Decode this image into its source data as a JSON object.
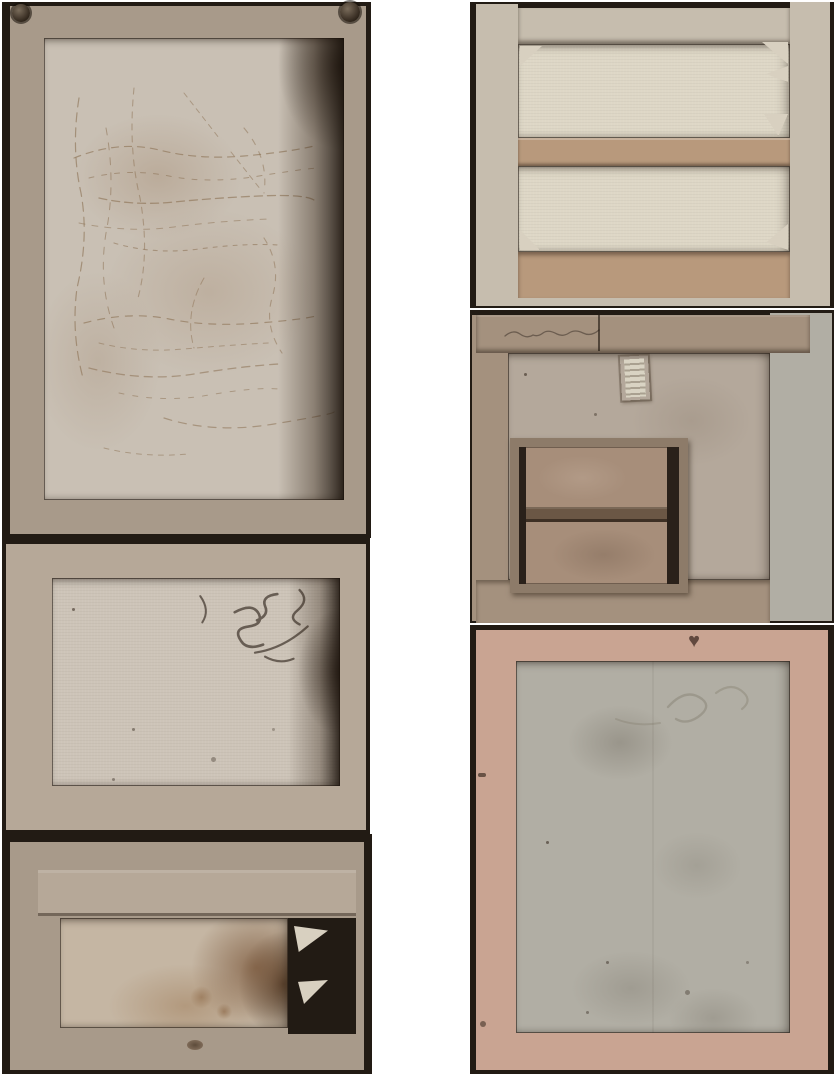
{
  "scene": {
    "type": "photograph-composite",
    "description": "Backs (versos) of six old paintings - canvases on wooden stretcher frames - photographed and arranged as two vertical columns on a white background",
    "background": "#ffffff"
  },
  "colors": {
    "edge-dark": "#221b14",
    "wood-light": "#b6a898",
    "wood-mid": "#a89a8a",
    "wood-taupe": "#a4917e",
    "wood-pink": "#c9a492",
    "wood-pale": "#c6bdae",
    "crossbar-tan": "#b8997c",
    "canvas-craquelure": "#c9c0b4",
    "canvas-plain": "#cdc4b8",
    "canvas-stained": "#c5b6a3",
    "canvas-pale": "#ded7c6",
    "canvas-taupe": "#b4a89b",
    "canvas-gray": "#b1aea4",
    "inner-frame-wood": "#8d7b69",
    "inner-frame-dark": "#2a211a",
    "inner-panel": "#a78e7a",
    "inner-crossbar": "#6b5745",
    "crack-brown": "#8b6f52",
    "scribble-dark": "#3e332a",
    "stain-brown": "#8a6547",
    "label-cream": "#d9d3c3",
    "stamp-brown": "#503930",
    "key-light": "#d8d0c0"
  },
  "panels": [
    {
      "label": "verso with craquelure-covered canvas in gray wooden stretcher, nail heads at top corners"
    },
    {
      "label": "verso with plain pale canvas and dark handwritten scribbles at upper right"
    },
    {
      "label": "verso with heavily stained mottled canvas and broken right edge showing keys"
    },
    {
      "label": "verso stretcher with central crossbar, pale canvas panels and corner keys"
    },
    {
      "label": "verso canvas with small white label and an attached smaller stretcher frame"
    },
    {
      "label": "verso with pink stretcher bars, gray canvas and small heart-shaped stamp"
    }
  ],
  "marks": {
    "heart_stamp_glyph": "♥"
  }
}
